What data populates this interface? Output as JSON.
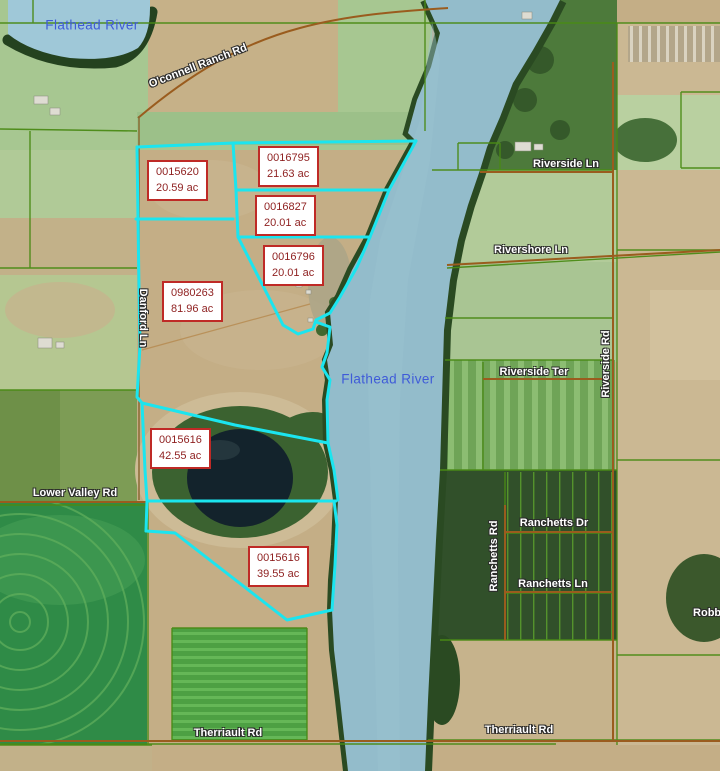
{
  "rivers": {
    "top_label": "Flathead River",
    "middle_label": "Flathead River"
  },
  "parcels": [
    {
      "id": "0015620",
      "acreage": "20.59 ac"
    },
    {
      "id": "0016795",
      "acreage": "21.63 ac"
    },
    {
      "id": "0016827",
      "acreage": "20.01 ac"
    },
    {
      "id": "0016796",
      "acreage": "20.01 ac"
    },
    {
      "id": "0980263",
      "acreage": "81.96 ac"
    },
    {
      "id": "0015616",
      "acreage": "42.55 ac"
    },
    {
      "id": "0015616",
      "acreage": "39.55 ac"
    }
  ],
  "roads": {
    "oconnell": "O'connell Ranch Rd",
    "riverside_ln": "Riverside Ln",
    "rivershore_ln": "Rivershore Ln",
    "riverside_ter": "Riverside Ter",
    "riverside_rd": "Riverside Rd",
    "danford_ln": "Danford Ln",
    "lower_valley_rd": "Lower Valley Rd",
    "ranchetts_rd": "Ranchetts Rd",
    "ranchetts_dr": "Ranchetts Dr",
    "ranchetts_ln": "Ranchetts Ln",
    "therriault_rd_west": "Therriault Rd",
    "therriault_rd_east": "Therriault Rd",
    "robbin": "Robbin"
  },
  "colors": {
    "parcel_highlight": "#1be5ef",
    "parcel_label_border": "#bf2a26",
    "parcel_label_text": "#8e1f1f",
    "water_label_text": "#3f5bd8",
    "parcel_line_green": "#4a8a15",
    "road_brown": "#9a5c1e",
    "river_water": "#93bccb"
  }
}
